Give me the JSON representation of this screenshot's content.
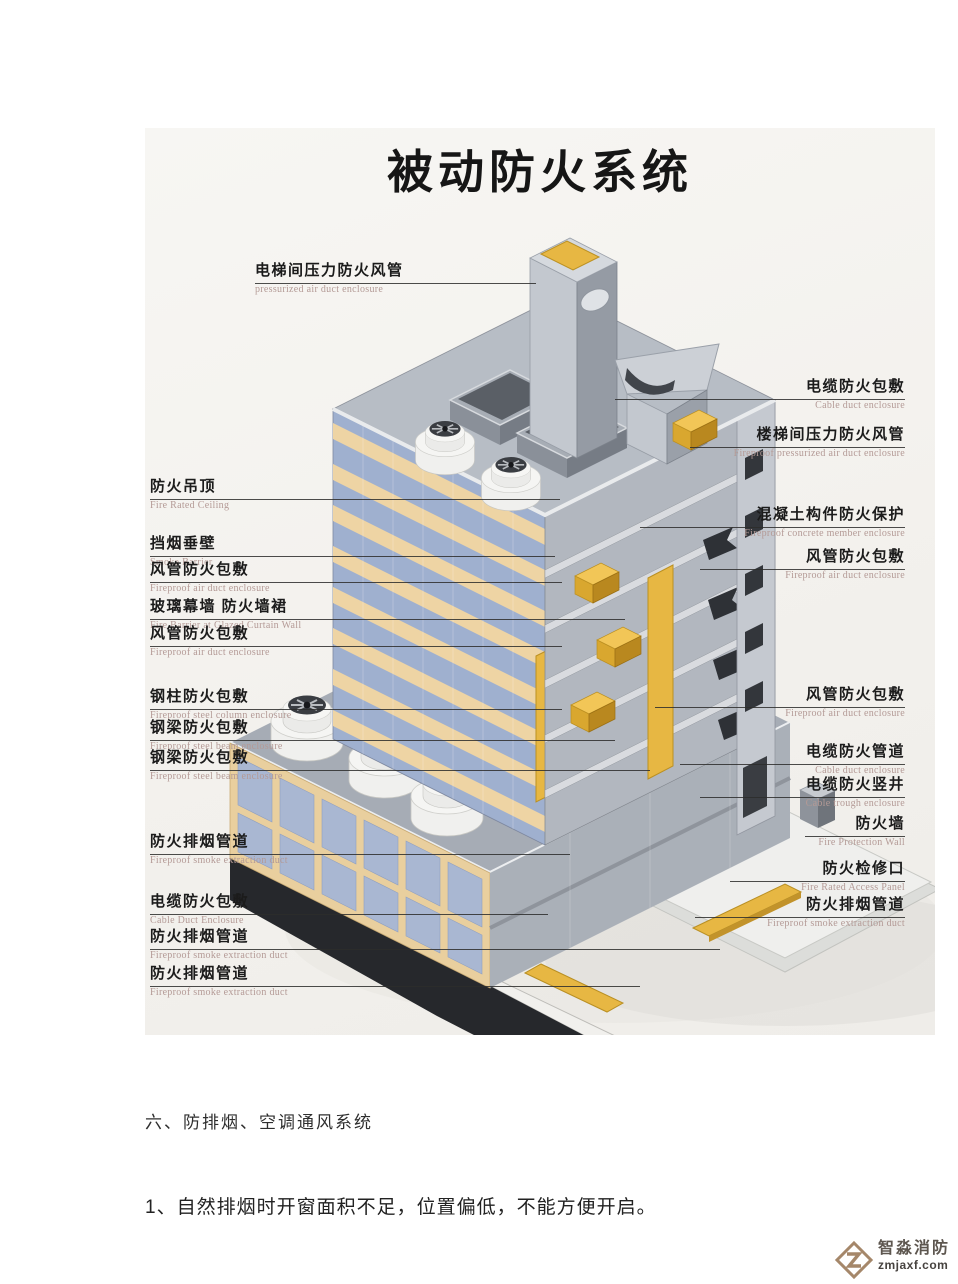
{
  "diagram": {
    "title": "被动防火系统",
    "labels_left": [
      {
        "zh": "电梯间压力防火风管",
        "en": "pressurized air duct enclosure"
      },
      {
        "zh": "防火吊顶",
        "en": "Fire Rated Ceiling"
      },
      {
        "zh": "挡烟垂壁",
        "en": "Smoke Barrier"
      },
      {
        "zh": "风管防火包敷",
        "en": "Fireproof air duct enclosure"
      },
      {
        "zh": "玻璃幕墙 防火墙裙",
        "en": "Fire Barrier at Glazed Curtain Wall"
      },
      {
        "zh": "风管防火包敷",
        "en": "Fireproof air duct enclosure"
      },
      {
        "zh": "钢柱防火包敷",
        "en": "Fireproof steel column enclosure"
      },
      {
        "zh": "钢梁防火包敷",
        "en": "Fireproof steel beam enclosure"
      },
      {
        "zh": "钢梁防火包敷",
        "en": "Fireproof steel beam enclosure"
      },
      {
        "zh": "防火排烟管道",
        "en": "Fireproof smoke extraction duct"
      },
      {
        "zh": "电缆防火包敷",
        "en": "Cable Duct Enclosure"
      },
      {
        "zh": "防火排烟管道",
        "en": "Fireproof smoke extraction duct"
      },
      {
        "zh": "防火排烟管道",
        "en": "Fireproof smoke extraction duct"
      }
    ],
    "labels_right": [
      {
        "zh": "电缆防火包敷",
        "en": "Cable duct enclosure"
      },
      {
        "zh": "楼梯间压力防火风管",
        "en": "Fireproof pressurized air duct enclosure"
      },
      {
        "zh": "混凝土构件防火保护",
        "en": "Fireproof concrete member enclosure"
      },
      {
        "zh": "风管防火包敷",
        "en": "Fireproof air duct enclosure"
      },
      {
        "zh": "风管防火包敷",
        "en": "Fireproof air duct enclosure"
      },
      {
        "zh": "电缆防火管道",
        "en": "Cable duct enclosure"
      },
      {
        "zh": "电缆防火竖井",
        "en": "Cable trough enclosure"
      },
      {
        "zh": "防火墙",
        "en": "Fire Protection Wall"
      },
      {
        "zh": "防火检修口",
        "en": "Fire Rated Access Panel"
      },
      {
        "zh": "防火排烟管道",
        "en": "Fireproof smoke extraction duct"
      }
    ],
    "palette": {
      "glass_blue": "#a3b2cf",
      "band_tan": "#eed4a4",
      "duct_yellow": "#e7b743",
      "concrete_gray": "#b4bac2",
      "ramp_dark": "#26282c",
      "leader_line": "#2d2d2b",
      "english_label": "#b49a96"
    }
  },
  "body_text": {
    "section_heading": "六、防排烟、空调通风系统",
    "item_1": "1、自然排烟时开窗面积不足，位置偏低，不能方便开启。"
  },
  "logo": {
    "name": "智淼消防",
    "site": "zmjaxf.com"
  }
}
